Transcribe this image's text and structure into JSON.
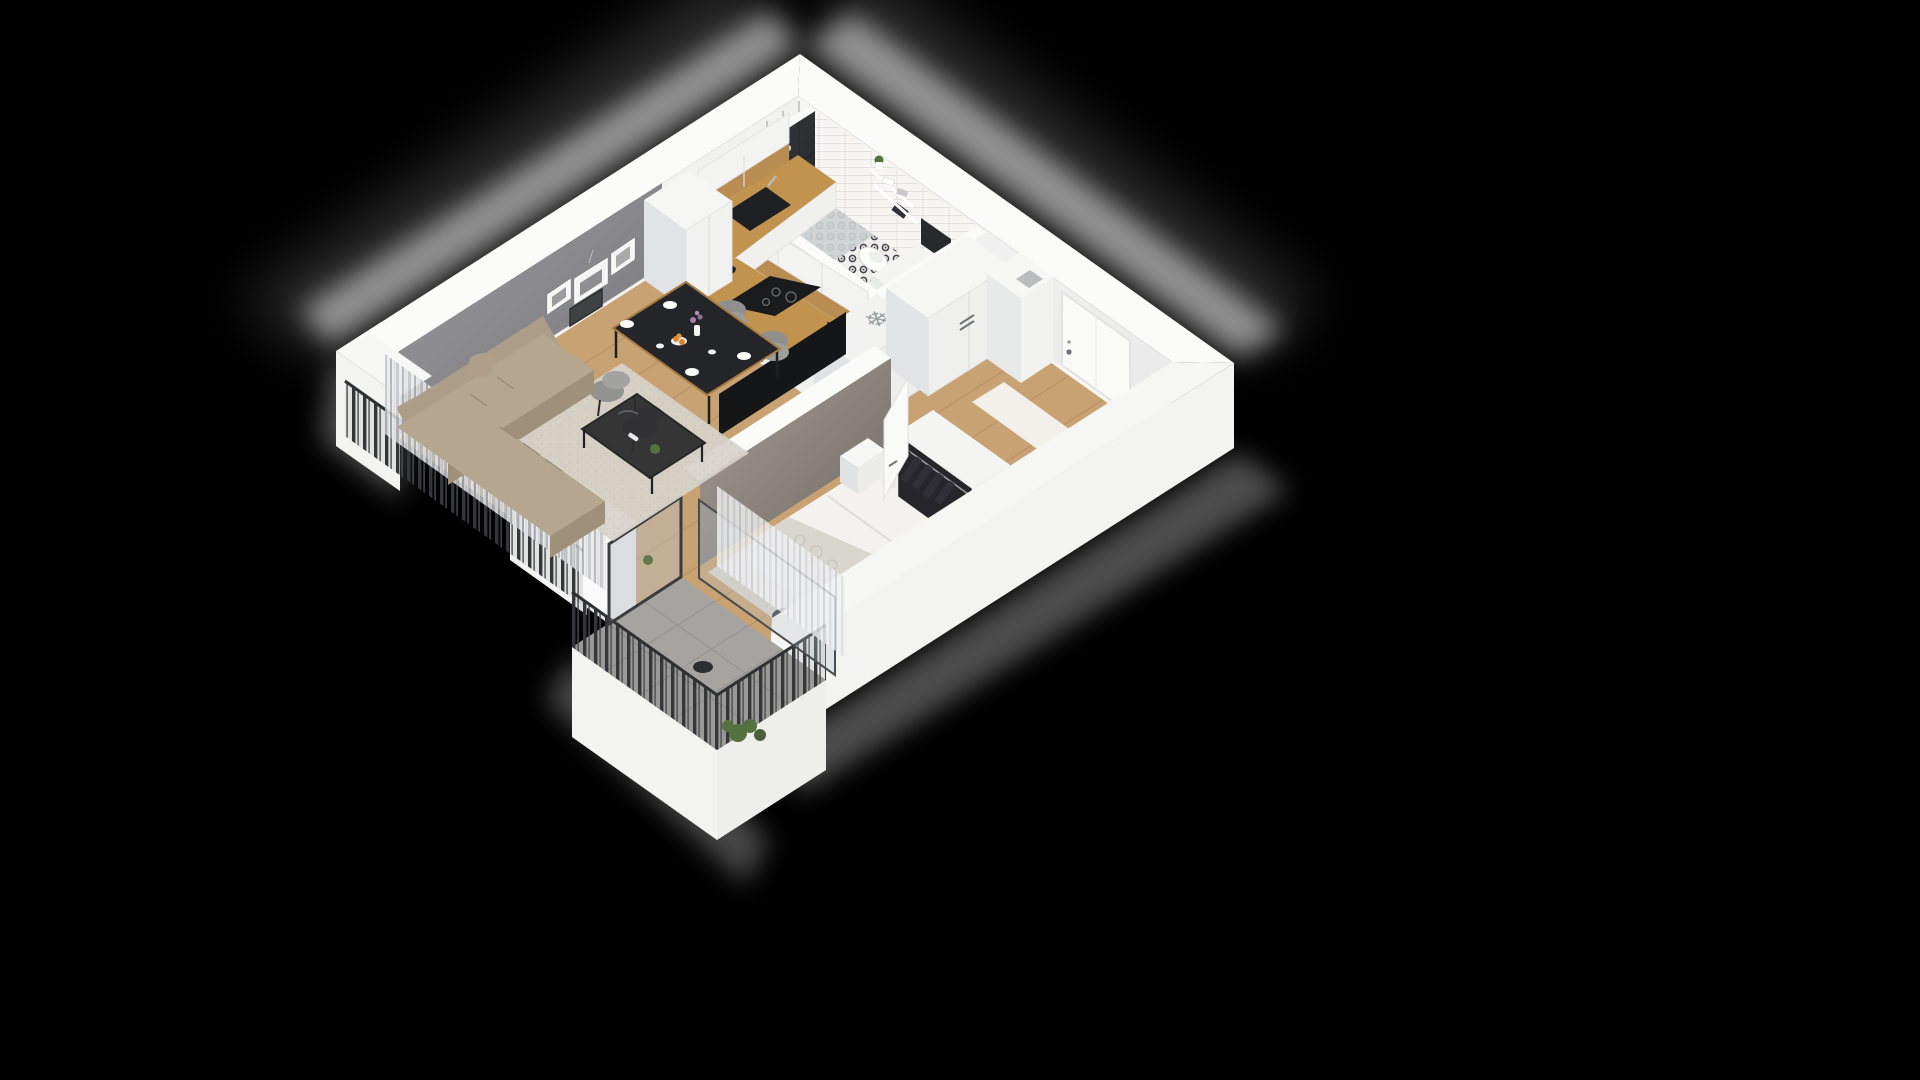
{
  "scene": {
    "type": "3d-isometric-floor-plan",
    "subject": "one-bedroom apartment cutaway render",
    "background": "#000000",
    "view": "isometric from above"
  },
  "icons": {
    "freezer_snowflake": "❄"
  },
  "palette": {
    "background": "#000000",
    "wall_white": "#f3f3f2",
    "wall_top": "#fbfbfa",
    "wall_shade": "#e4e5e6",
    "gray_wall_light": "#97969a",
    "gray_wall_dark": "#7b7a7e",
    "wood": "#c9a273",
    "wood_line": "#a98257",
    "counter_wood": "#c2924f",
    "cabinet_white": "#f1f1f0",
    "cabinet_shade": "#e2e3e4",
    "appliance_black": "#1d1e20",
    "steel": "#b9bcbf",
    "shower_black": "#2e3033",
    "tile_white": "#f6f5f2",
    "bath_pattern_ink": "#41434a",
    "concrete": "#a5a4a1",
    "concrete_line": "#8e8d89",
    "railing": "#34363a",
    "curtain_gray": "#c9c9cd",
    "curtain_white": "#eef0f2",
    "sofa_top": "#b5a78f",
    "sofa_side": "#9f907a",
    "rug_living": "#d7d3cb",
    "rug_bedroom": "#dedbd4",
    "table_black": "#242528",
    "table_wood_edge": "#a87c42",
    "chair_gray": "#9b9b99",
    "tv_black": "#151618",
    "duvet_white": "#f4f2ef",
    "blanket_gray": "#d9d6d0",
    "clothes_dark": "#2a2a2f",
    "box_gray": "#8f9193",
    "door_white": "#fafaf9",
    "plant_green": "#55713f",
    "orange_fruit": "#e08a2f",
    "flower_purple": "#a183a8",
    "glass_tint": "#b9c4ca",
    "mat_white": "#f6f6f5",
    "poster_orange": "#e2762d"
  },
  "rooms": [
    {
      "id": "living-room",
      "label": "Living room",
      "furniture": [
        "corner sofa",
        "coffee table",
        "area rug",
        "dining table with four chairs",
        "wall art frames",
        "TV on partition wall",
        "curtains"
      ]
    },
    {
      "id": "kitchen",
      "label": "Kitchen",
      "furniture": [
        "L-shaped counter",
        "sink",
        "hob",
        "oven",
        "upper cabinets",
        "tall cabinet",
        "fridge with freezer symbol",
        "kettle"
      ]
    },
    {
      "id": "bathroom",
      "label": "Bathroom",
      "furniture": [
        "black tiled walk-in shower",
        "wall-hung toilet",
        "washing machine",
        "shelves with towels",
        "patterned tile floor"
      ]
    },
    {
      "id": "hallway",
      "label": "Hallway",
      "furniture": [
        "entrance door",
        "tall wardrobe",
        "chimney pier",
        "door mat",
        "leaning poster"
      ]
    },
    {
      "id": "bedroom",
      "label": "Bedroom",
      "furniture": [
        "double bed",
        "open wardrobe with clothes",
        "shelf unit with boxes",
        "nightstand",
        "rug",
        "basket",
        "curtains"
      ]
    },
    {
      "id": "balcony",
      "label": "Balcony",
      "furniture": [
        "metal slat railing",
        "concrete tile floor",
        "potted plants",
        "side stool",
        "glass doors"
      ]
    }
  ]
}
